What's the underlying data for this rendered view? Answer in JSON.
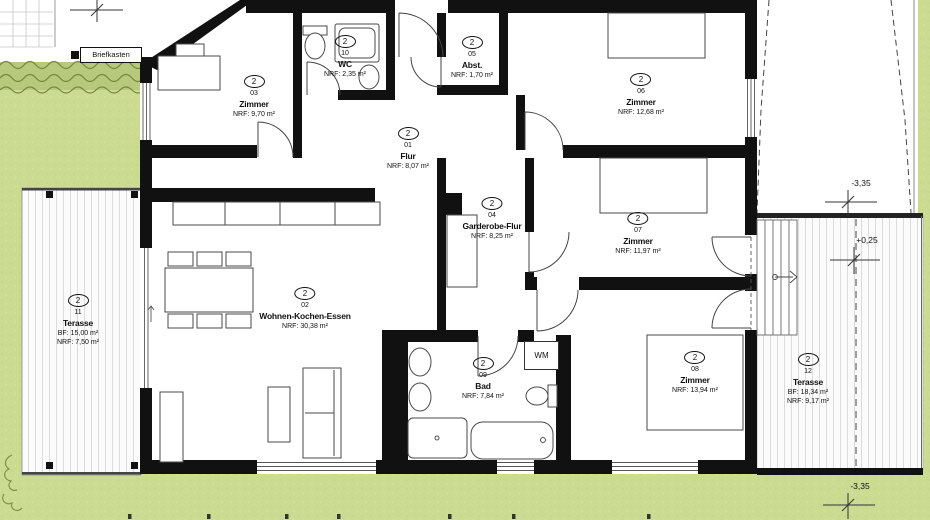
{
  "meta": {
    "unit_badge": "2",
    "drawing_type": "floor-plan"
  },
  "rooms": [
    {
      "num": "01",
      "name": "Flur",
      "line1": "NRF: 8,07 m²"
    },
    {
      "num": "02",
      "name": "Wohnen-Kochen-Essen",
      "line1": "NRF: 30,38 m²"
    },
    {
      "num": "03",
      "name": "Zimmer",
      "line1": "NRF: 9,70 m²"
    },
    {
      "num": "04",
      "name": "Garderobe-Flur",
      "line1": "NRF: 8,25 m²"
    },
    {
      "num": "05",
      "name": "Abst.",
      "line1": "NRF: 1,70 m²"
    },
    {
      "num": "06",
      "name": "Zimmer",
      "line1": "NRF: 12,68 m²"
    },
    {
      "num": "07",
      "name": "Zimmer",
      "line1": "NRF: 11,97 m²"
    },
    {
      "num": "08",
      "name": "Zimmer",
      "line1": "NRF: 13,94 m²"
    },
    {
      "num": "09",
      "name": "Bad",
      "line1": "NRF: 7,84 m²"
    },
    {
      "num": "10",
      "name": "WC",
      "line1": "NRF: 2,35 m²"
    },
    {
      "num": "11",
      "name": "Terasse",
      "line1": "BF: 15,00 m²",
      "line2": "NRF: 7,50 m²"
    },
    {
      "num": "12",
      "name": "Terasse",
      "line1": "BF: 18,34 m²",
      "line2": "NRF: 9,17 m²"
    }
  ],
  "annotations": {
    "briefkasten": "Briefkasten",
    "wm": "WM",
    "elev_top_right": "-3,35",
    "elev_mid_right": "+0,25",
    "elev_bottom_right": "-3,35"
  },
  "colors": {
    "grass": "#cbdc92",
    "hedge": "#b6c97d",
    "hedge_line": "#74893f",
    "wall": "#111111",
    "deck_line": "#dcdcdc",
    "text": "#111111"
  }
}
